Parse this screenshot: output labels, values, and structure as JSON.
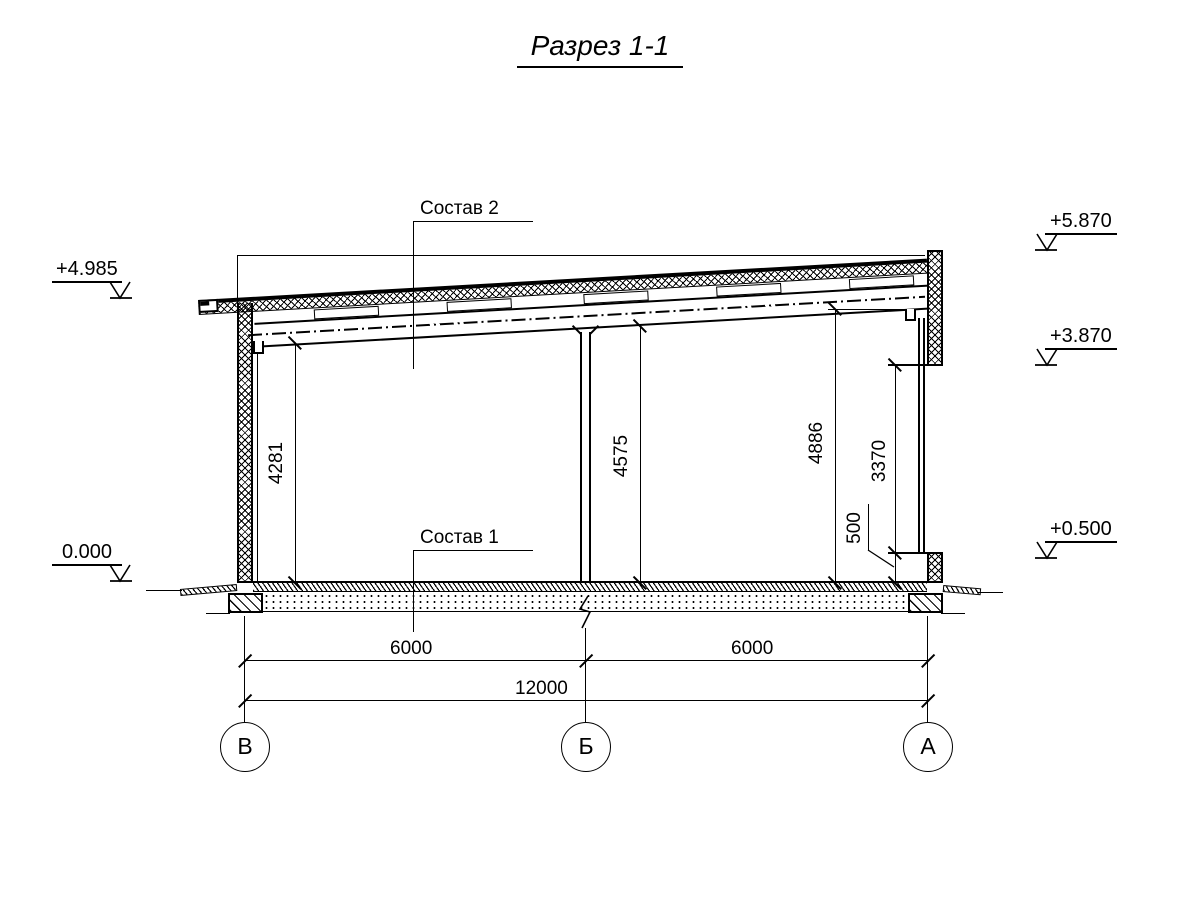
{
  "sheet": {
    "title": "Разрез 1-1"
  },
  "elevation_marks": {
    "plus_4_985": "+4.985",
    "zero": "0.000",
    "plus_5_870": "+5.870",
    "plus_3_870": "+3.870",
    "plus_0_500": "+0.500"
  },
  "callouts": {
    "sostav_2": "Состав 2",
    "sostav_1": "Состав 1"
  },
  "dimensions": {
    "v_4281": "4281",
    "v_4575": "4575",
    "v_4886": "4886",
    "v_3370": "3370",
    "v_500": "500",
    "h_6000_left": "6000",
    "h_6000_right": "6000",
    "h_12000": "12000"
  },
  "axis_bubbles": {
    "left": "В",
    "middle": "Б",
    "right": "А"
  },
  "colors": {
    "line": "#000000",
    "background": "#ffffff"
  }
}
